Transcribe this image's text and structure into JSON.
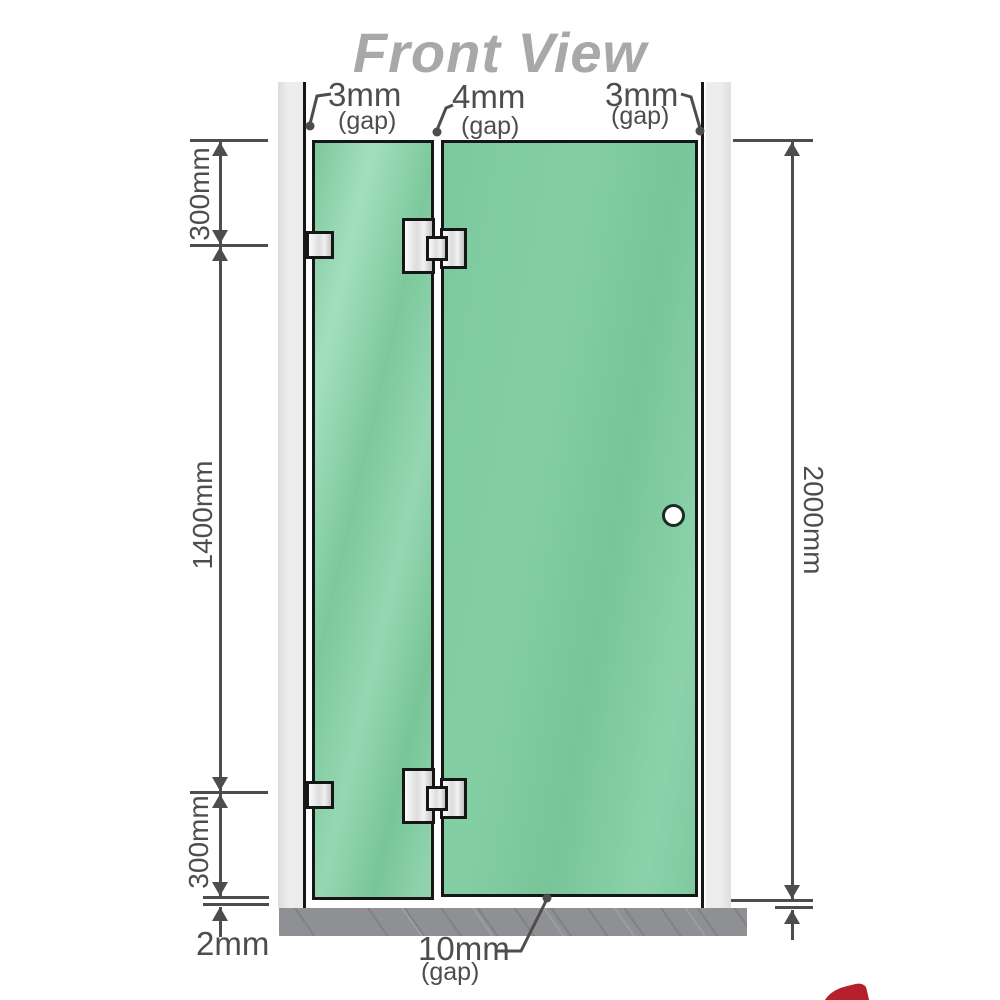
{
  "title": "Front View",
  "annotations": {
    "gap_top_left": {
      "value": "3mm",
      "suffix": "(gap)"
    },
    "gap_top_middle": {
      "value": "4mm",
      "suffix": "(gap)"
    },
    "gap_top_right": {
      "value": "3mm",
      "suffix": "(gap)"
    },
    "gap_bottom": {
      "value": "10mm",
      "suffix": "(gap)"
    }
  },
  "dimensions": {
    "left_top": "300mm",
    "left_middle": "1400mm",
    "left_bottom": "300mm",
    "bottom_left": "2mm",
    "right_total": "2000mm"
  },
  "colors": {
    "glass": "#7ec9a0",
    "wall": "#eaeaea",
    "base": "#8e9094",
    "dim": "#4d4d4d",
    "title": "#a8a8a8",
    "accent_red": "#b5202c"
  }
}
